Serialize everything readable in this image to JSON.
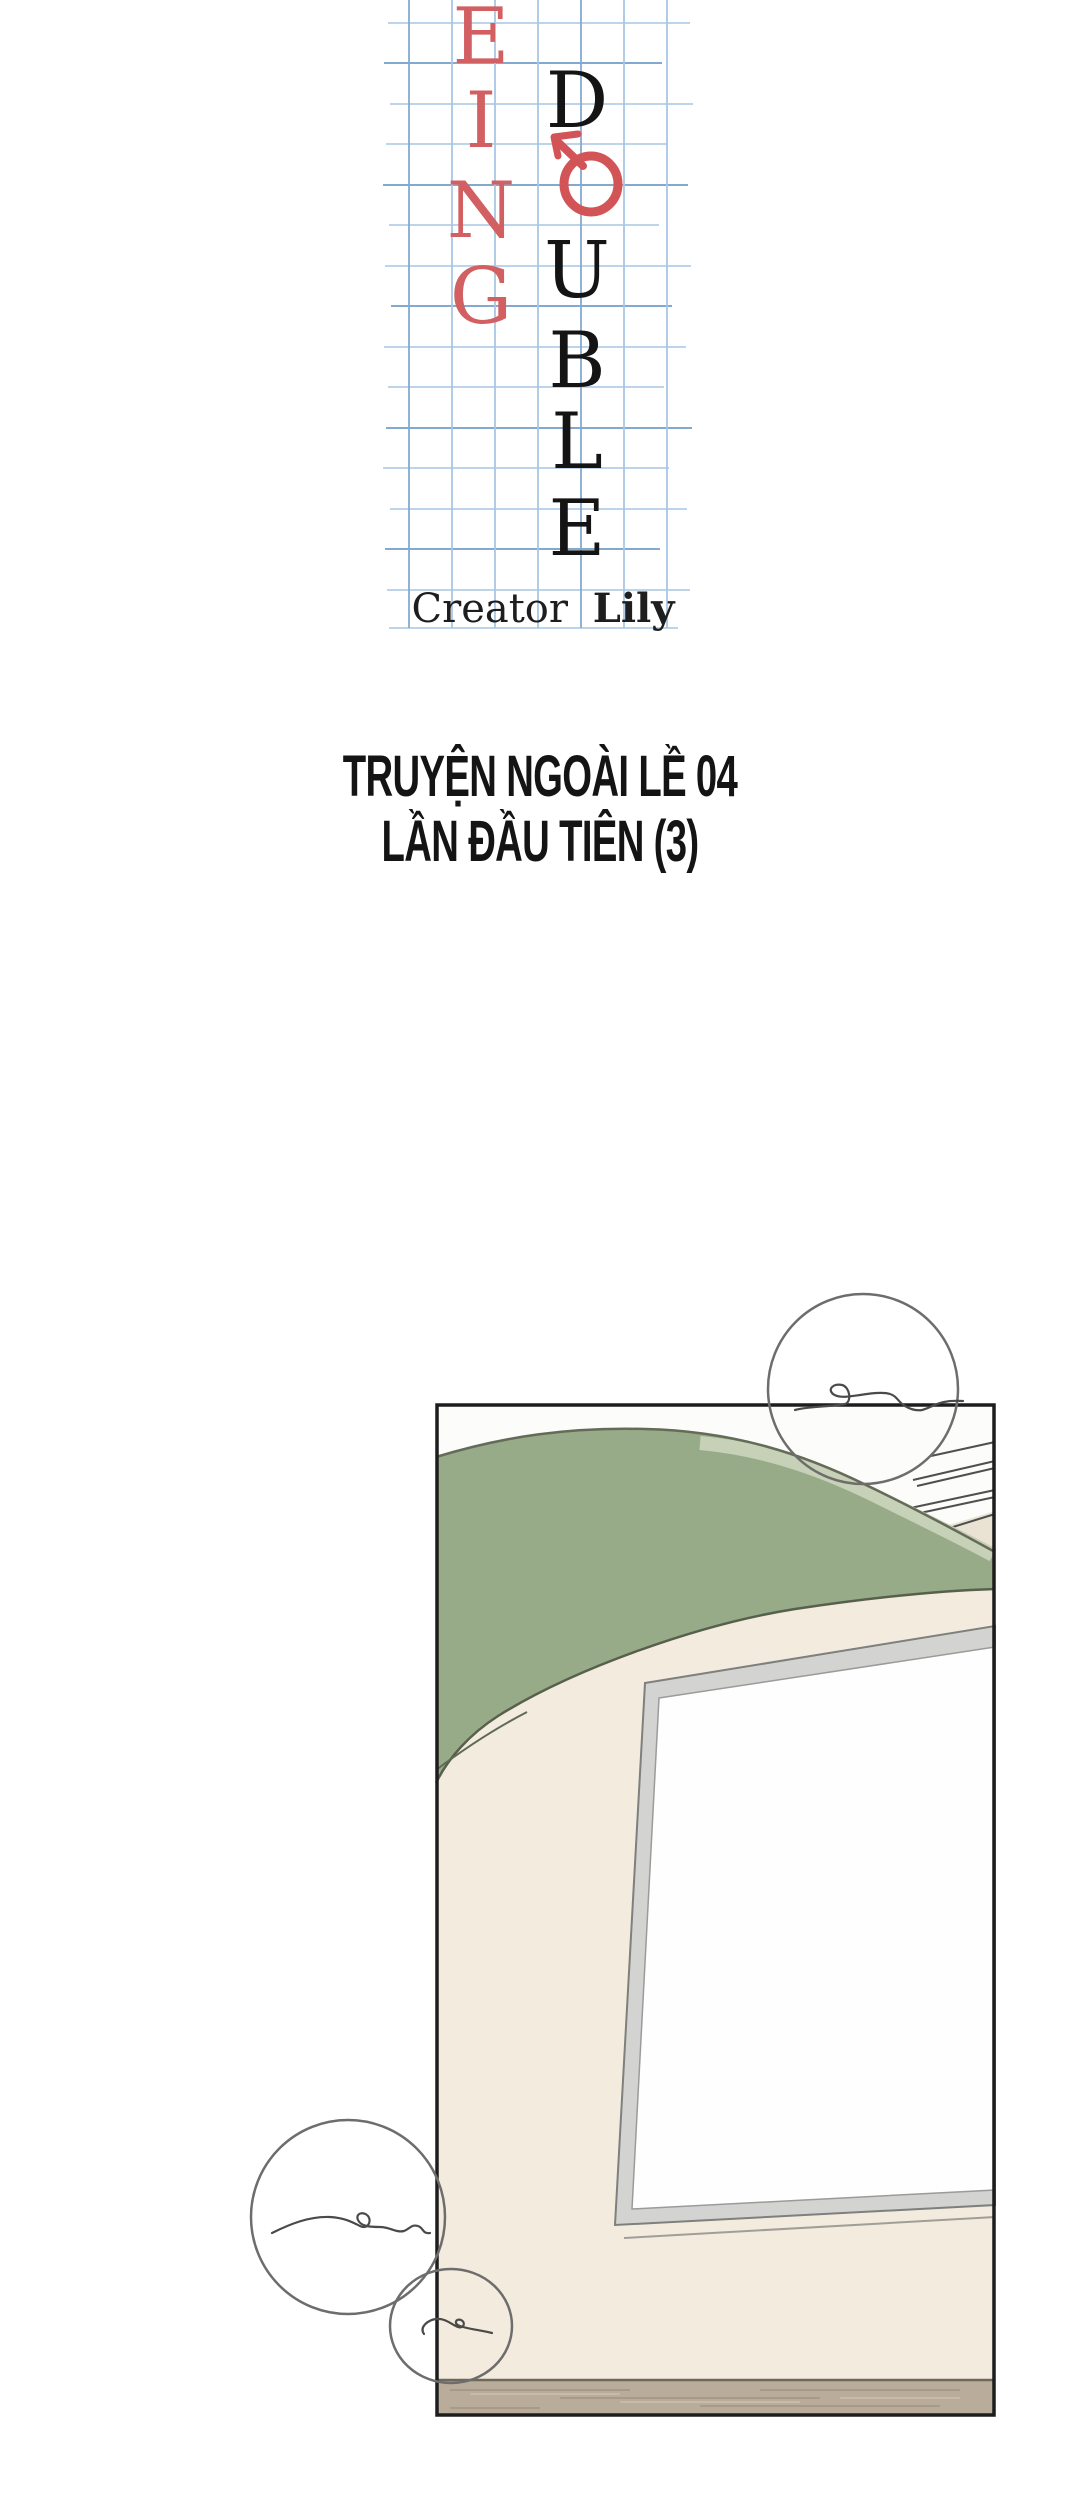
{
  "title_logo": {
    "red_letters": [
      "E",
      "I",
      "N",
      "G"
    ],
    "black_top_letter": "D",
    "red_o": "O",
    "black_bottom_letters": [
      "U",
      "B",
      "L",
      "E"
    ],
    "credit_prefix": "Creator",
    "credit_name": "Lily",
    "accent_red": "#d25f62",
    "grid_blue_light": "#a8c6e4",
    "grid_blue_dark": "#84a9cf",
    "ink_black": "#141414"
  },
  "chapter_title": {
    "line1": "TRUYỆN NGOÀI LỀ 04",
    "line2": "LẦN ĐẦU TIÊN (3)"
  },
  "panel": {
    "colors": {
      "border_ink": "#1d1d1d",
      "sofa_green": "#97ab88",
      "sofa_green_light": "#c6d1b7",
      "sofa_outline": "#646b58",
      "wall_white": "#fcfcfb",
      "wall_beige": "#f3ebdd",
      "wall_beige_dark": "#eae2d3",
      "whiteboard_frame_gray": "#d3d4d2",
      "whiteboard_white": "#fefefe",
      "floor_wood": "#b9ac9a",
      "doodle_gray": "#6d6d6d"
    }
  }
}
